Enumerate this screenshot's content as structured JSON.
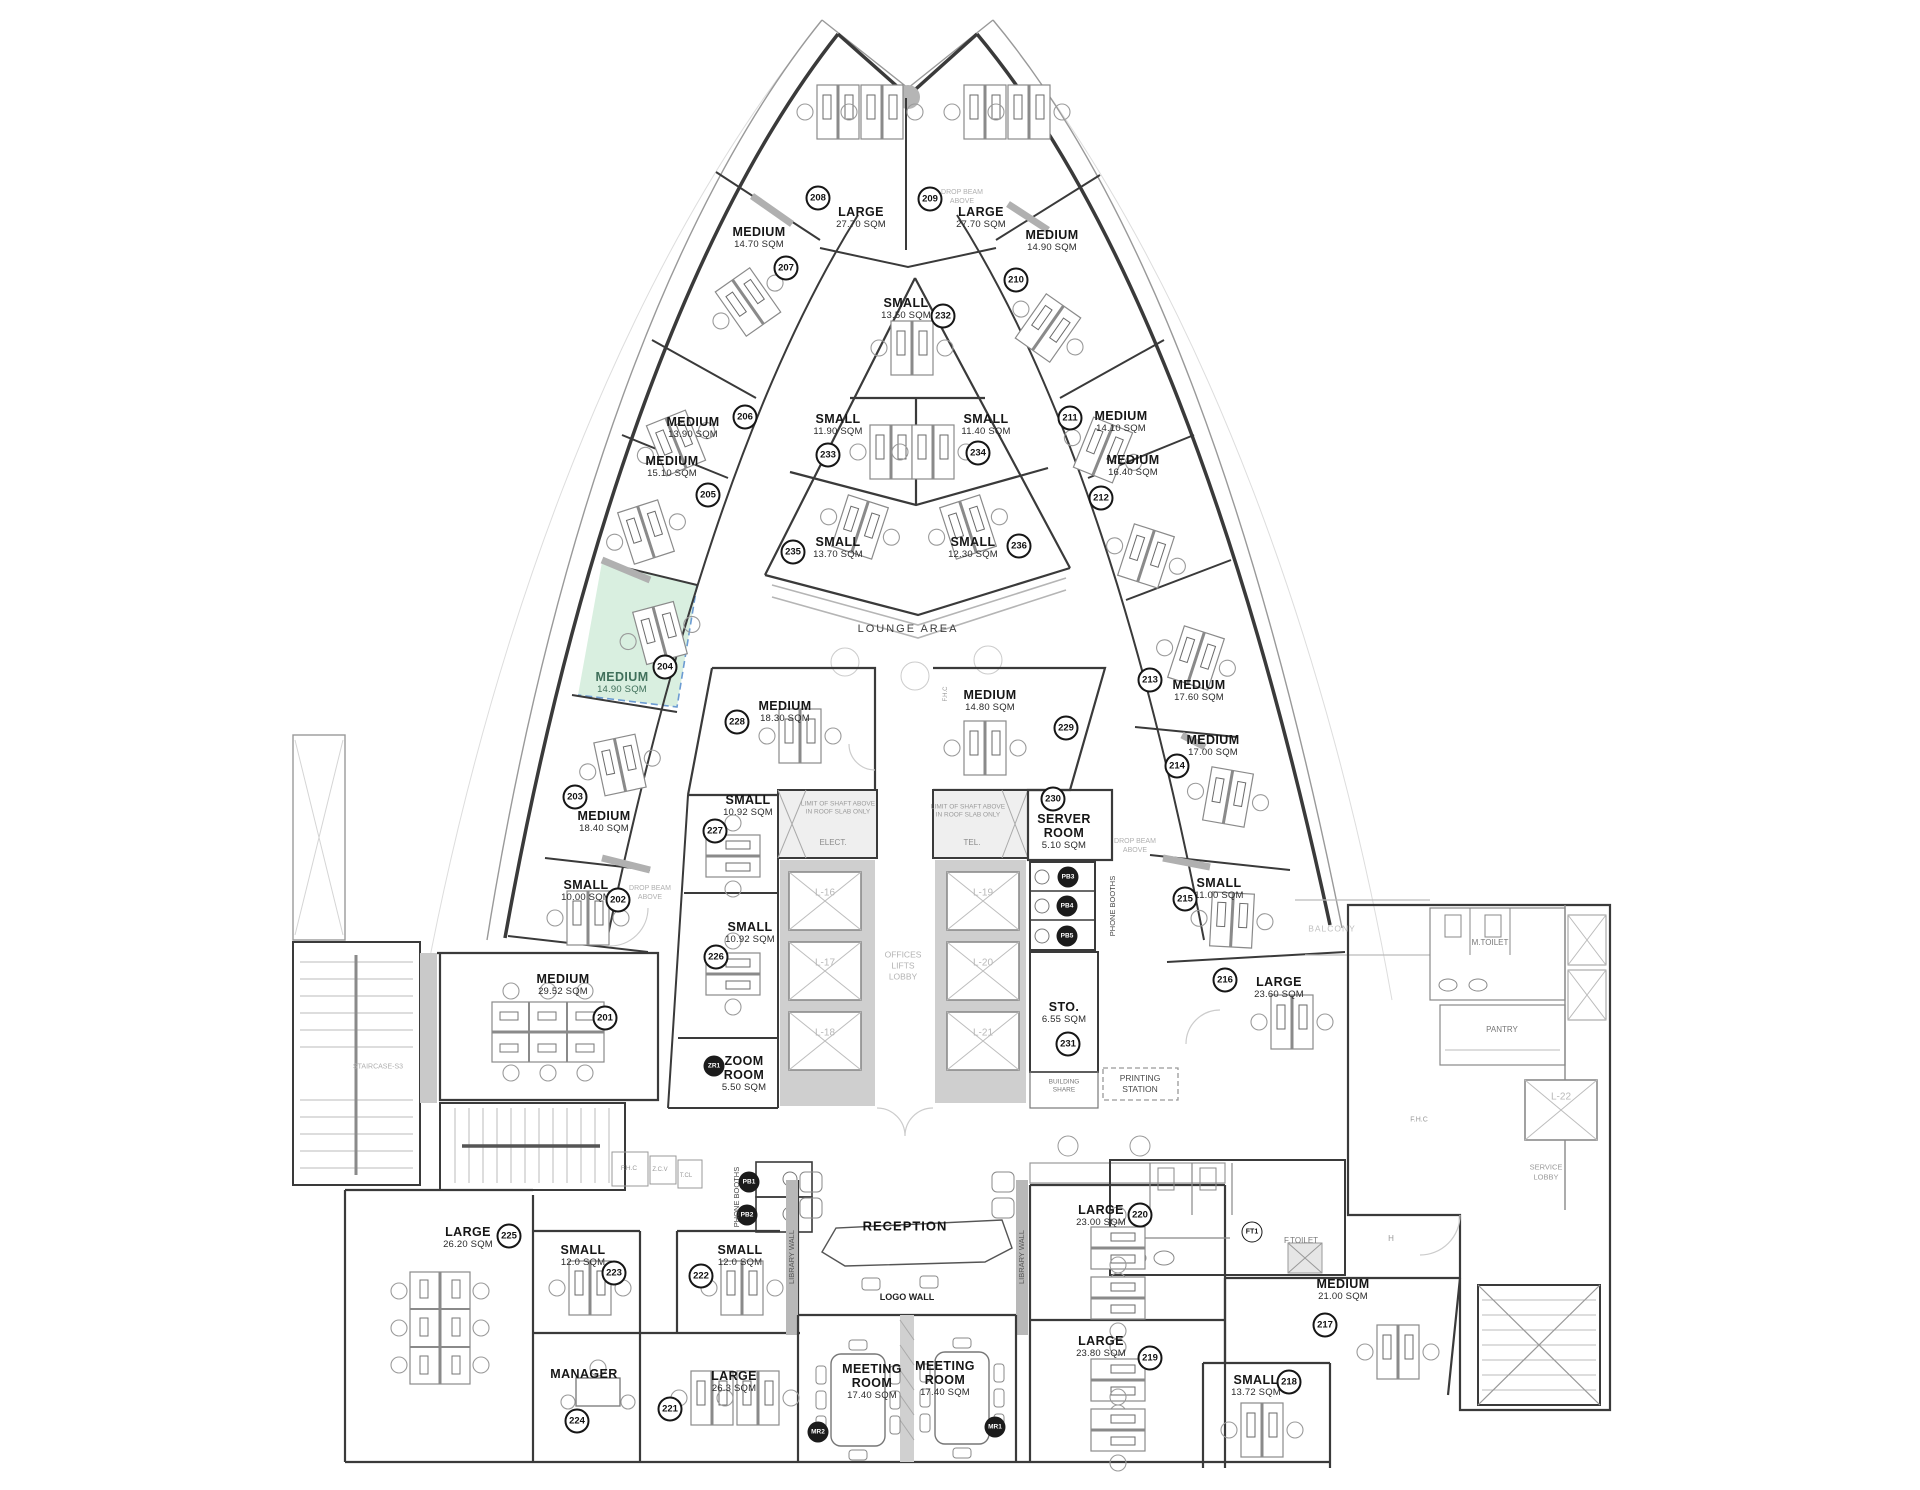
{
  "highlight": {
    "room": "204",
    "color": "#d9efe0",
    "border": "#6b9bd2",
    "label_color": "#3f6f5a"
  },
  "rooms": [
    {
      "n": "208",
      "name": "LARGE",
      "area": "27.70 SQM",
      "l": [
        861,
        218
      ],
      "c": [
        818,
        198
      ]
    },
    {
      "n": "209",
      "name": "LARGE",
      "area": "27.70 SQM",
      "l": [
        981,
        218
      ],
      "c": [
        930,
        199
      ]
    },
    {
      "n": "207",
      "name": "MEDIUM",
      "area": "14.70 SQM",
      "l": [
        759,
        238
      ],
      "c": [
        786,
        268
      ]
    },
    {
      "n": "210",
      "name": "MEDIUM",
      "area": "14.90 SQM",
      "l": [
        1052,
        241
      ],
      "c": [
        1016,
        280
      ]
    },
    {
      "n": "232",
      "name": "SMALL",
      "area": "13.50 SQM",
      "l": [
        906,
        309
      ],
      "c": [
        943,
        316
      ]
    },
    {
      "n": "233",
      "name": "SMALL",
      "area": "11.90 SQM",
      "l": [
        838,
        425
      ],
      "c": [
        828,
        455
      ]
    },
    {
      "n": "234",
      "name": "SMALL",
      "area": "11.40 SQM",
      "l": [
        986,
        425
      ],
      "c": [
        978,
        453
      ]
    },
    {
      "n": "206",
      "name": "MEDIUM",
      "area": "13.90 SQM",
      "l": [
        693,
        428
      ],
      "c": [
        745,
        417
      ]
    },
    {
      "n": "205",
      "name": "MEDIUM",
      "area": "15.10 SQM",
      "l": [
        672,
        467
      ],
      "c": [
        708,
        495
      ]
    },
    {
      "n": "211",
      "name": "MEDIUM",
      "area": "14.10 SQM",
      "l": [
        1121,
        422
      ],
      "c": [
        1070,
        418
      ]
    },
    {
      "n": "212",
      "name": "MEDIUM",
      "area": "16.40 SQM",
      "l": [
        1133,
        466
      ],
      "c": [
        1101,
        498
      ]
    },
    {
      "n": "235",
      "name": "SMALL",
      "area": "13.70 SQM",
      "l": [
        838,
        548
      ],
      "c": [
        793,
        552
      ]
    },
    {
      "n": "236",
      "name": "SMALL",
      "area": "12.30 SQM",
      "l": [
        973,
        548
      ],
      "c": [
        1019,
        546
      ]
    },
    {
      "n": "204",
      "name": "MEDIUM",
      "area": "14.90 SQM",
      "l": [
        622,
        683
      ],
      "c": [
        665,
        667
      ],
      "hl": true
    },
    {
      "n": "213",
      "name": "MEDIUM",
      "area": "17.60 SQM",
      "l": [
        1199,
        691
      ],
      "c": [
        1150,
        680
      ]
    },
    {
      "n": "228",
      "name": "MEDIUM",
      "area": "18.30 SQM",
      "l": [
        785,
        712
      ],
      "c": [
        737,
        722
      ]
    },
    {
      "n": "229",
      "name": "MEDIUM",
      "area": "14.80 SQM",
      "l": [
        990,
        701
      ],
      "c": [
        1066,
        728
      ]
    },
    {
      "n": "214",
      "name": "MEDIUM",
      "area": "17.00 SQM",
      "l": [
        1213,
        746
      ],
      "c": [
        1177,
        766
      ]
    },
    {
      "n": "203",
      "name": "MEDIUM",
      "area": "18.40 SQM",
      "l": [
        604,
        822
      ],
      "c": [
        575,
        797
      ]
    },
    {
      "n": "227",
      "name": "SMALL",
      "area": "10.92 SQM",
      "l": [
        748,
        806
      ],
      "c": [
        715,
        831
      ]
    },
    {
      "n": "230",
      "name": "SERVER\nROOM",
      "area": "5.10 SQM",
      "l": [
        1064,
        832
      ],
      "c": [
        1053,
        799
      ]
    },
    {
      "n": "202",
      "name": "SMALL",
      "area": "10.00 SQM",
      "l": [
        586,
        891
      ],
      "c": [
        618,
        900
      ]
    },
    {
      "n": "215",
      "name": "SMALL",
      "area": "11.00 SQM",
      "l": [
        1219,
        889
      ],
      "c": [
        1185,
        899
      ]
    },
    {
      "n": "226",
      "name": "SMALL",
      "area": "10.92 SQM",
      "l": [
        750,
        933
      ],
      "c": [
        716,
        957
      ]
    },
    {
      "n": "201",
      "name": "MEDIUM",
      "area": "29.52 SQM",
      "l": [
        563,
        985
      ],
      "c": [
        605,
        1018
      ]
    },
    {
      "n": "216",
      "name": "LARGE",
      "area": "23.60 SQM",
      "l": [
        1279,
        988
      ],
      "c": [
        1225,
        980
      ]
    },
    {
      "n": "231",
      "name": "STO.",
      "area": "6.55 SQM",
      "l": [
        1064,
        1013
      ],
      "c": [
        1068,
        1044
      ]
    },
    {
      "n": "ZR1",
      "name": "ZOOM\nROOM",
      "area": "5.50 SQM",
      "l": [
        744,
        1074
      ],
      "c": [
        714,
        1066
      ],
      "dark": true
    },
    {
      "n": "225",
      "name": "LARGE",
      "area": "26.20 SQM",
      "l": [
        468,
        1238
      ],
      "c": [
        509,
        1236
      ]
    },
    {
      "n": "223",
      "name": "SMALL",
      "area": "12.0 SQM",
      "l": [
        583,
        1256
      ],
      "c": [
        614,
        1273
      ]
    },
    {
      "n": "222",
      "name": "SMALL",
      "area": "12.0 SQM",
      "l": [
        740,
        1256
      ],
      "c": [
        701,
        1276
      ]
    },
    {
      "n": "224",
      "name": "MANAGER",
      "area": "",
      "l": [
        584,
        1374
      ],
      "c": [
        577,
        1421
      ]
    },
    {
      "n": "221",
      "name": "LARGE",
      "area": "26.3 SQM",
      "l": [
        734,
        1382
      ],
      "c": [
        670,
        1409
      ]
    },
    {
      "n": "MR2",
      "name": "MEETING\nROOM",
      "area": "17.40 SQM",
      "l": [
        872,
        1382
      ],
      "c": [
        818,
        1432
      ],
      "dark": true
    },
    {
      "n": "MR1",
      "name": "MEETING\nROOM",
      "area": "17.40 SQM",
      "l": [
        945,
        1379
      ],
      "c": [
        995,
        1427
      ],
      "dark": true
    },
    {
      "n": "220",
      "name": "LARGE",
      "area": "23.00 SQM",
      "l": [
        1101,
        1216
      ],
      "c": [
        1140,
        1215
      ]
    },
    {
      "n": "219",
      "name": "LARGE",
      "area": "23.80 SQM",
      "l": [
        1101,
        1347
      ],
      "c": [
        1150,
        1358
      ]
    },
    {
      "n": "217",
      "name": "MEDIUM",
      "area": "21.00 SQM",
      "l": [
        1343,
        1290
      ],
      "c": [
        1325,
        1325
      ]
    },
    {
      "n": "218",
      "name": "SMALL",
      "area": "13.72 SQM",
      "l": [
        1256,
        1386
      ],
      "c": [
        1289,
        1382
      ]
    }
  ],
  "badges": [
    {
      "t": "PB1",
      "p": [
        749,
        1182
      ],
      "dark": true
    },
    {
      "t": "PB2",
      "p": [
        747,
        1215
      ],
      "dark": true
    },
    {
      "t": "PB3",
      "p": [
        1068,
        877
      ],
      "dark": true
    },
    {
      "t": "PB4",
      "p": [
        1067,
        906
      ],
      "dark": true
    },
    {
      "t": "PB5",
      "p": [
        1067,
        936
      ],
      "dark": true
    },
    {
      "t": "FT1",
      "p": [
        1252,
        1232
      ],
      "dark": false
    }
  ],
  "notes": [
    {
      "t": "LOUNGE AREA",
      "p": [
        908,
        629
      ],
      "s": 11,
      "c": "#3c3c3c",
      "ls": 2
    },
    {
      "t": "RECEPTION",
      "p": [
        905,
        1227
      ],
      "s": 13,
      "c": "#141414",
      "b": 1,
      "ls": 1
    },
    {
      "t": "LOGO WALL",
      "p": [
        907,
        1298
      ],
      "s": 9,
      "c": "#222",
      "b": 1
    },
    {
      "t": "ELECT.",
      "p": [
        833,
        843
      ],
      "s": 8,
      "c": "#8a8a8a"
    },
    {
      "t": "TEL.",
      "p": [
        972,
        843
      ],
      "s": 8,
      "c": "#8a8a8a"
    },
    {
      "t": "LIMIT OF SHAFT ABOVE\nIN ROOF SLAB ONLY",
      "p": [
        838,
        809
      ],
      "s": 6.5,
      "c": "#9a9a9a"
    },
    {
      "t": "LIMIT OF SHAFT ABOVE\nIN ROOF SLAB ONLY",
      "p": [
        968,
        812
      ],
      "s": 6.5,
      "c": "#9a9a9a"
    },
    {
      "t": "OFFICES\nLIFTS\nLOBBY",
      "p": [
        903,
        966
      ],
      "s": 8.5,
      "c": "#b3b3b3"
    },
    {
      "t": "PHONE BOOTHS",
      "p": [
        1113,
        906
      ],
      "s": 7.5,
      "c": "#444",
      "r": -90
    },
    {
      "t": "PHONE BOOTHS",
      "p": [
        737,
        1197
      ],
      "s": 7.5,
      "c": "#444",
      "r": -90
    },
    {
      "t": "LIBRARY WALL",
      "p": [
        792,
        1257
      ],
      "s": 7.5,
      "c": "#555",
      "r": -90
    },
    {
      "t": "LIBRARY WALL",
      "p": [
        1022,
        1257
      ],
      "s": 7.5,
      "c": "#555",
      "r": -90
    },
    {
      "t": "BUILDING\nSHARE",
      "p": [
        1064,
        1087
      ],
      "s": 6.5,
      "c": "#777"
    },
    {
      "t": "PRINTING\nSTATION",
      "p": [
        1140,
        1084
      ],
      "s": 8.5,
      "c": "#4a4a4a"
    },
    {
      "t": "DROP BEAM\nABOVE",
      "p": [
        962,
        197
      ],
      "s": 7,
      "c": "#b0b0b0"
    },
    {
      "t": "DROP BEAM\nABOVE",
      "p": [
        650,
        893
      ],
      "s": 7,
      "c": "#b0b0b0"
    },
    {
      "t": "DROP BEAM\nABOVE",
      "p": [
        1135,
        846
      ],
      "s": 7,
      "c": "#b0b0b0"
    },
    {
      "t": "L-16",
      "p": [
        825,
        893
      ],
      "s": 10,
      "c": "#b8b8b8"
    },
    {
      "t": "L-17",
      "p": [
        825,
        963
      ],
      "s": 10,
      "c": "#b8b8b8"
    },
    {
      "t": "L-18",
      "p": [
        825,
        1033
      ],
      "s": 10,
      "c": "#b8b8b8"
    },
    {
      "t": "L-19",
      "p": [
        983,
        893
      ],
      "s": 10,
      "c": "#b8b8b8"
    },
    {
      "t": "L-20",
      "p": [
        983,
        963
      ],
      "s": 10,
      "c": "#b8b8b8"
    },
    {
      "t": "L-21",
      "p": [
        983,
        1033
      ],
      "s": 10,
      "c": "#b8b8b8"
    },
    {
      "t": "L-22",
      "p": [
        1561,
        1097
      ],
      "s": 10,
      "c": "#b8b8b8"
    },
    {
      "t": "STAIRCASE-S3",
      "p": [
        378,
        1067
      ],
      "s": 7,
      "c": "#b0b0b0"
    },
    {
      "t": "BALCONY",
      "p": [
        1332,
        929
      ],
      "s": 8.5,
      "c": "#c0c0c0",
      "ls": 1
    },
    {
      "t": "M.TOILET",
      "p": [
        1490,
        943
      ],
      "s": 8,
      "c": "#777"
    },
    {
      "t": "F.TOILET",
      "p": [
        1301,
        1241
      ],
      "s": 8,
      "c": "#777"
    },
    {
      "t": "H",
      "p": [
        1391,
        1239
      ],
      "s": 8,
      "c": "#999"
    },
    {
      "t": "PANTRY",
      "p": [
        1502,
        1030
      ],
      "s": 8,
      "c": "#777"
    },
    {
      "t": "SERVICE\nLOBBY",
      "p": [
        1546,
        1172
      ],
      "s": 7.5,
      "c": "#9a9a9a"
    },
    {
      "t": "F.H.C",
      "p": [
        947,
        694
      ],
      "s": 6,
      "c": "#999",
      "r": -90
    },
    {
      "t": "F.H.C",
      "p": [
        629,
        1169
      ],
      "s": 6.5,
      "c": "#999"
    },
    {
      "t": "Z.C.V",
      "p": [
        660,
        1171
      ],
      "s": 6,
      "c": "#999"
    },
    {
      "t": "T.CL",
      "p": [
        686,
        1177
      ],
      "s": 6,
      "c": "#999"
    },
    {
      "t": "F.H.C",
      "p": [
        1419,
        1120
      ],
      "s": 7,
      "c": "#999"
    }
  ]
}
